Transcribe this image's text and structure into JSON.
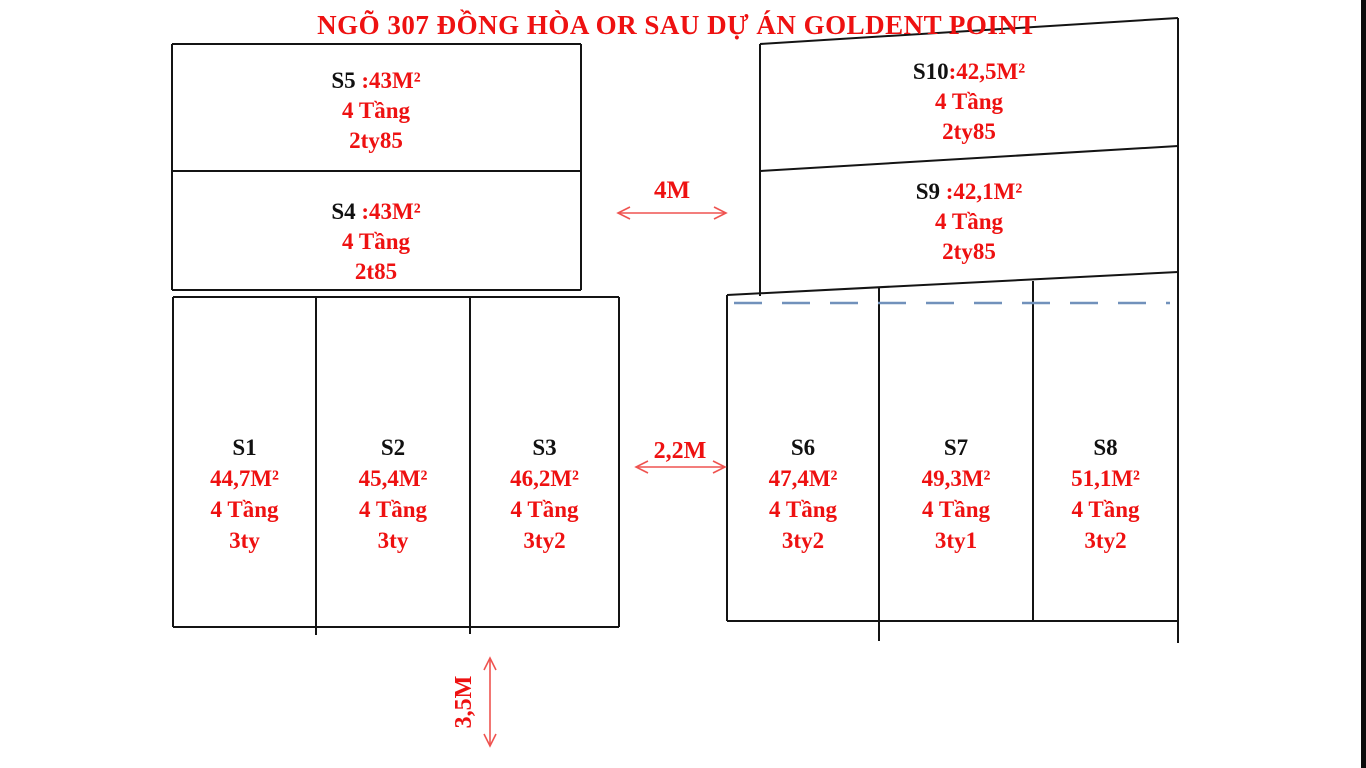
{
  "title": "NGÕ 307 ĐỒNG HÒA OR SAU DỰ ÁN GOLDENT POINT",
  "colors": {
    "text_red": "#ee1111",
    "arrow_red": "#ef5350",
    "line_black": "#141414",
    "dash_blue": "#7191bb"
  },
  "plots": {
    "s5": {
      "id": "S5",
      "area": " :43M²",
      "floors": "4 Tầng",
      "price": "2ty85"
    },
    "s4": {
      "id": "S4",
      "area": " :43M²",
      "floors": "4 Tầng",
      "price": "2t85"
    },
    "s10": {
      "id": "S10",
      "area": ":42,5M²",
      "floors": "4 Tầng",
      "price": "2ty85"
    },
    "s9": {
      "id": "S9",
      "area": " :42,1M²",
      "floors": "4 Tầng",
      "price": "2ty85"
    },
    "s1": {
      "id": "S1",
      "area": "44,7M²",
      "floors": "4 Tầng",
      "price": "3ty"
    },
    "s2": {
      "id": "S2",
      "area": "45,4M²",
      "floors": "4 Tầng",
      "price": "3ty"
    },
    "s3": {
      "id": "S3",
      "area": "46,2M²",
      "floors": "4 Tầng",
      "price": "3ty2"
    },
    "s6": {
      "id": "S6",
      "area": "47,4M²",
      "floors": "4 Tầng",
      "price": "3ty2"
    },
    "s7": {
      "id": "S7",
      "area": "49,3M²",
      "floors": "4 Tầng",
      "price": "3ty1"
    },
    "s8": {
      "id": "S8",
      "area": "51,1M²",
      "floors": "4 Tầng",
      "price": "3ty2"
    }
  },
  "dimensions": {
    "road_top": "4M",
    "road_right": "2,2M",
    "road_bottom": "3,5M"
  }
}
